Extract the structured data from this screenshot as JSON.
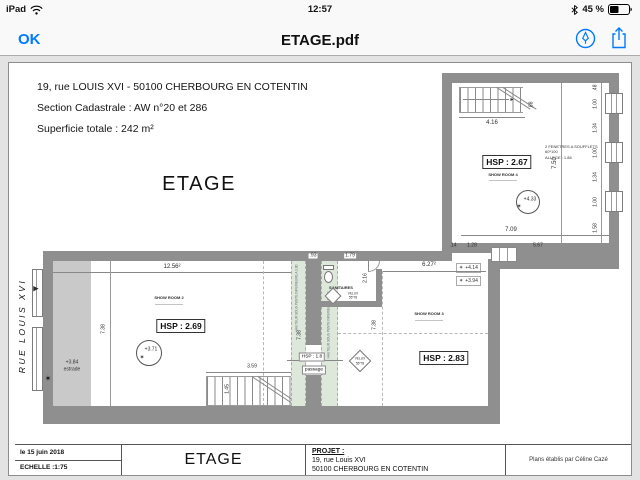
{
  "status_bar": {
    "device": "iPad",
    "time": "12:57",
    "battery_pct": "45 %"
  },
  "toolbar": {
    "back_label": "OK",
    "title": "ETAGE.pdf"
  },
  "colors": {
    "accent": "#007aff",
    "wall": "#8f8f8f",
    "estrade": "#c9c9c9",
    "slope_zone": "#dde8da",
    "bar_bg": "#f9f9f9"
  },
  "icons": {
    "wifi": "wifi-icon",
    "bluetooth": "bluetooth-icon",
    "battery": "battery-icon",
    "markup": "markup-icon",
    "share": "share-icon",
    "north_star": "✶",
    "level_star": "✶",
    "street_arrow": "▶",
    "stair_arrow": "▸"
  },
  "header": {
    "line1": "19, rue LOUIS XVI  - 50100 CHERBOURG EN COTENTIN",
    "line2": "Section Cadastrale : AW n°20 et 286",
    "line3": "Superficie totale : 242 m²",
    "plan_title": "ETAGE"
  },
  "street": {
    "label": "RUE  LOUIS  XVI"
  },
  "rooms": {
    "showroom4": {
      "name": "SHOW ROOM 4",
      "hsp": "HSP : 2.67",
      "level": "+4.33",
      "window_note_1": "2 FENETRES A SOUFFLETS 60*100",
      "window_note_2": "ALLEGE : 1.86"
    },
    "showroom2": {
      "name": "SHOW ROOM 2",
      "hsp": "HSP : 2.69",
      "level": "+3.71"
    },
    "showroom3": {
      "name": "SHOW ROOM 3",
      "hsp": "HSP : 2.83"
    },
    "sanitaires": {
      "name": "SANITAIRES",
      "velux_label": "VELUX",
      "velux_size": "55*78"
    },
    "passage": {
      "hsp": "HSP : 1.8",
      "name": "passage",
      "velux_label": "VELUX",
      "velux_size": "55*78",
      "slope_note": "HAUTEUR SOUS PENTE INFERIEURE A 1.80"
    },
    "estrade": {
      "level": "+3.84",
      "name": "estrade"
    }
  },
  "levels": {
    "upper_landing": "+4.14",
    "lower_landing": "+3.94"
  },
  "dims": {
    "stair_up": "4.16",
    "stair_up_w": ".88",
    "room4_h": "7.50",
    "room4_w": "7.09",
    "j1": ".14",
    "j2": "1.28",
    "j3": "5.67",
    "chain": [
      ".48",
      "1.00",
      "1.34",
      "1.00",
      "1.34",
      "1.00",
      "1.58"
    ],
    "room2_w": "12.56²",
    "room2_h": "7.38",
    "stair_dn": "3.59",
    "stair_dn_w": "1.45",
    "mid_wall": ".93",
    "sanit_w": "1.79",
    "sanit_h": "2.16",
    "room3_w": "6.27²"
  },
  "title_block": {
    "date": "le 15 juin 2018",
    "scale": "ECHELLE :1:75",
    "sheet": "ETAGE",
    "project_label": "PROJET :",
    "project_line1": "19, rue Louis XVI",
    "project_line2": "50100 CHERBOURG EN COTENTIN",
    "credit": "Plans établis par Céline Cazé"
  }
}
